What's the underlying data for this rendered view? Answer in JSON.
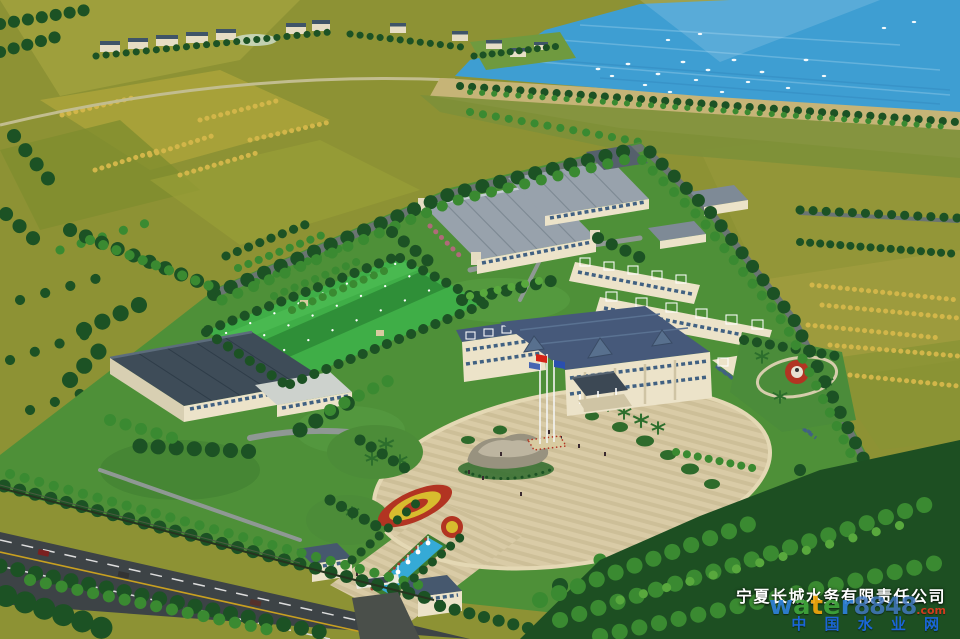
{
  "watermark": {
    "company_name": "宁夏长城水务有限责任公司",
    "brand_letters": [
      "w",
      "a",
      "t",
      "e",
      "r"
    ],
    "brand_number": "8848",
    "brand_suffix": ".com",
    "portal_name": "中 国 水 业 网",
    "colors": {
      "company": "#ffffff",
      "brand_letters": [
        "#2e7fd6",
        "#3fa33a",
        "#f0a50c",
        "#3fa33a",
        "#2e7fd6"
      ],
      "brand_number": "#4a86d8",
      "brand_suffix": "#e03a1e",
      "portal": "#1b66d8"
    }
  },
  "palette": {
    "lake_blue": "#3e9ed2",
    "dike_sand": "#c6b477",
    "field_olive": "#8d9234",
    "crop_yellow": "#d2b649",
    "campus_grass": "#4e9038",
    "sports_lawn": "#3fae47",
    "tree_dark": "#1c5224",
    "tree_light": "#3a8a31",
    "plaza_tan": "#d9cba6",
    "road_dark": "#3d4346",
    "roof_slate": "#46597a",
    "roof_industrial": "#98a2ac",
    "wall_cream": "#ece3c9",
    "fountain_blue": "#35aad6",
    "flower_red": "#b23422",
    "flower_yellow": "#d8bc2e",
    "flag_red": "#d42418",
    "flag_blue": "#2a4fae"
  }
}
